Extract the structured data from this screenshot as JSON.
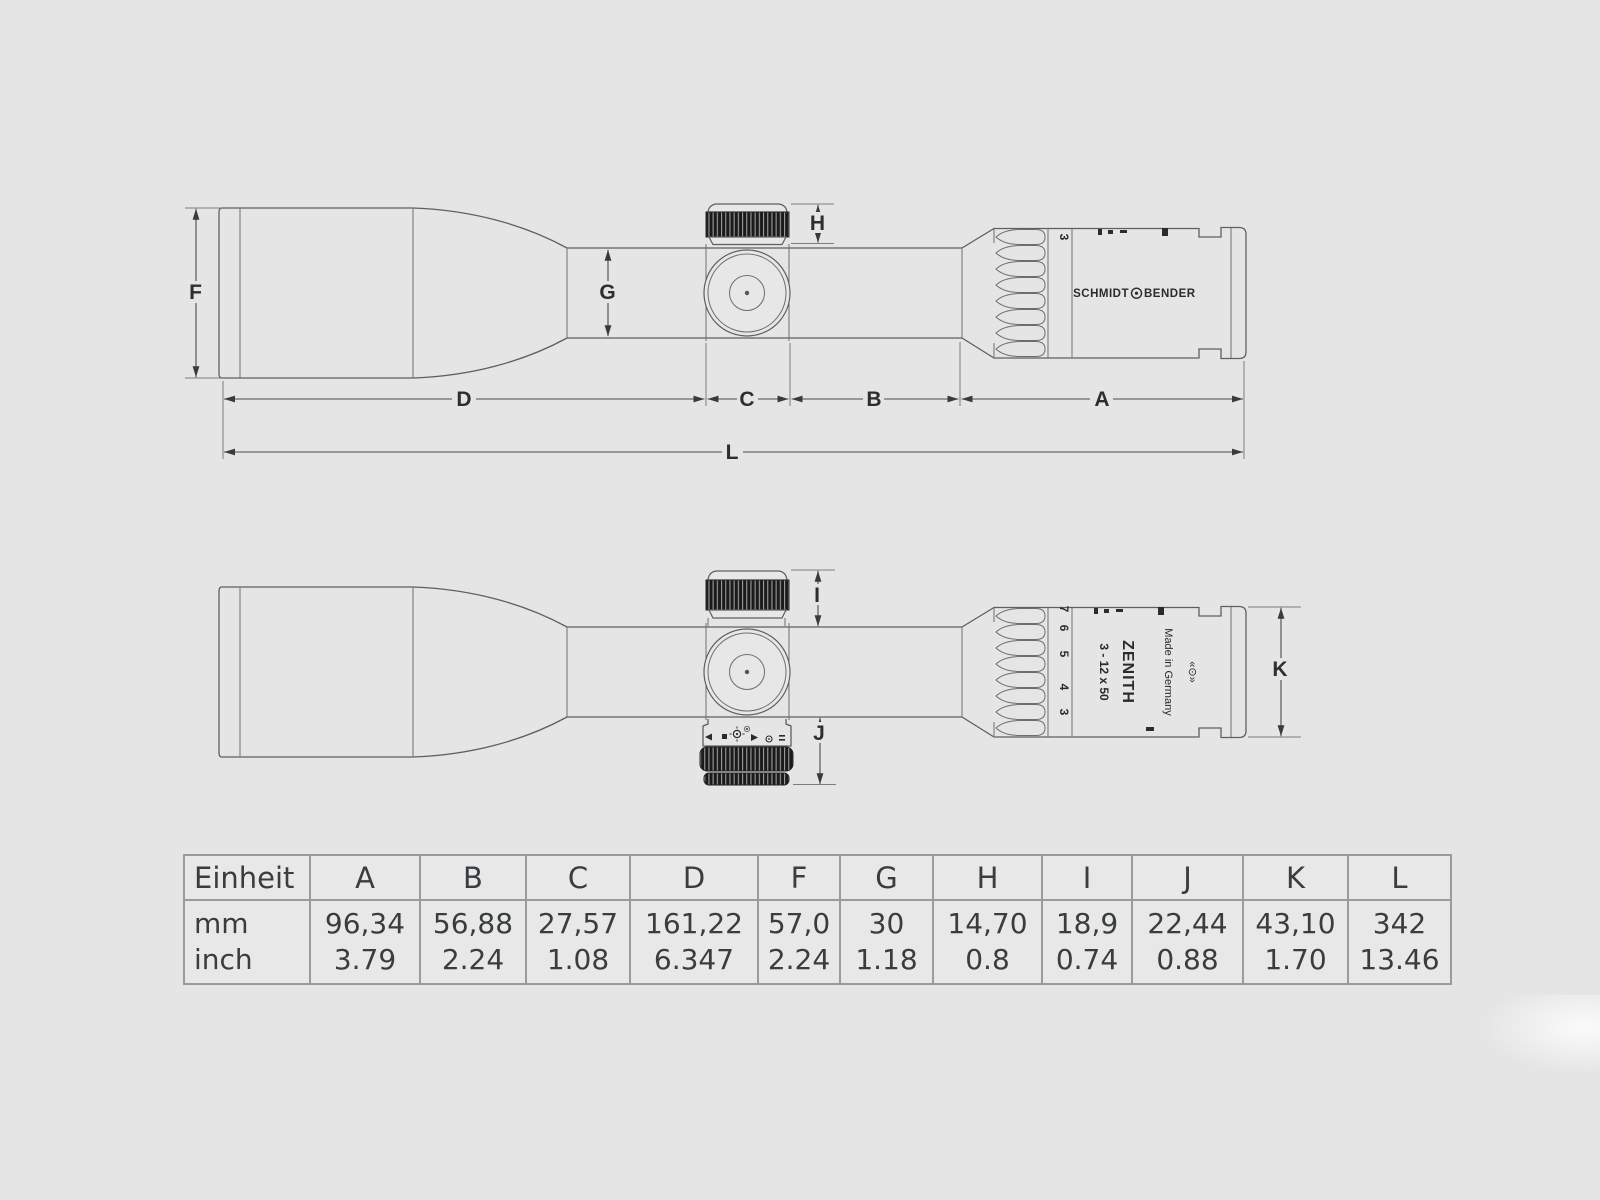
{
  "colors": {
    "background": "#e5e5e5",
    "drawing_line": "#5f5f5f",
    "dimension_line": "#4a4a4a",
    "label_text": "#2e2e2e",
    "table_border": "#9b9b9b",
    "table_text": "#3a3d3f",
    "knurl_dark": "#1b1b1b"
  },
  "diagram": {
    "brand_left": "SCHMIDT",
    "brand_right": "BENDER",
    "model": "ZENITH",
    "spec": "3 - 12 x 50",
    "origin": "Made in Germany",
    "emblem": "«⊙»",
    "mag_current": "3",
    "zoom_scale": [
      "3",
      "4",
      "5",
      "6",
      "7"
    ],
    "dim_labels": {
      "a": "A",
      "b": "B",
      "c": "C",
      "d": "D",
      "f": "F",
      "g": "G",
      "h": "H",
      "i": "I",
      "j": "J",
      "k": "K",
      "l": "L"
    }
  },
  "table": {
    "unit_header": "Einheit",
    "columns": [
      "A",
      "B",
      "C",
      "D",
      "F",
      "G",
      "H",
      "I",
      "J",
      "K",
      "L"
    ],
    "rows": [
      {
        "unit": "mm",
        "values": [
          "96,34",
          "56,88",
          "27,57",
          "161,22",
          "57,0",
          "30",
          "14,70",
          "18,9",
          "22,44",
          "43,10",
          "342"
        ]
      },
      {
        "unit": "inch",
        "values": [
          "3.79",
          "2.24",
          "1.08",
          "6.347",
          "2.24",
          "1.18",
          "0.8",
          "0.74",
          "0.88",
          "1.70",
          "13.46"
        ]
      }
    ]
  }
}
